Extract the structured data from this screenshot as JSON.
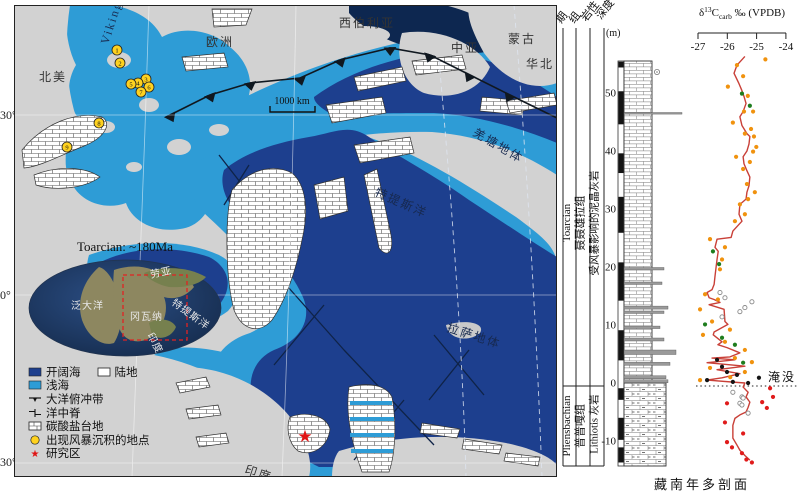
{
  "map": {
    "latitudes": [
      "30°",
      "0°",
      "30°"
    ],
    "scale_bar": "1000 km",
    "regions": [
      {
        "label": "北美",
        "x": 25,
        "y": 76
      },
      {
        "label": "欧洲",
        "x": 192,
        "y": 41
      },
      {
        "label": "西伯利亚",
        "x": 325,
        "y": 22
      },
      {
        "label": "中亚",
        "x": 437,
        "y": 47
      },
      {
        "label": "蒙古",
        "x": 494,
        "y": 38
      },
      {
        "label": "华北",
        "x": 512,
        "y": 63
      },
      {
        "label": "印度",
        "x": 230,
        "y": 468,
        "rot": 18
      },
      {
        "label": "澳大利亚",
        "x": 405,
        "y": 484
      }
    ],
    "sea_labels": [
      {
        "label": "特提斯洋",
        "x": 360,
        "y": 190,
        "rot": 24
      },
      {
        "label": "羌塘地体",
        "x": 458,
        "y": 130,
        "rot": 30
      },
      {
        "label": "拉萨地体",
        "x": 432,
        "y": 326,
        "rot": 18
      },
      {
        "label": "Viking",
        "x": 94,
        "y": 40,
        "rot": -72,
        "size": 9
      }
    ],
    "storm_sites": [
      {
        "n": "1",
        "x": 103,
        "y": 45
      },
      {
        "n": "2",
        "x": 106,
        "y": 58
      },
      {
        "n": "3",
        "x": 132,
        "y": 74
      },
      {
        "n": "4",
        "x": 124,
        "y": 78
      },
      {
        "n": "5",
        "x": 117,
        "y": 79
      },
      {
        "n": "6",
        "x": 135,
        "y": 82
      },
      {
        "n": "7",
        "x": 127,
        "y": 87
      },
      {
        "n": "8",
        "x": 85,
        "y": 118
      },
      {
        "n": "9",
        "x": 53,
        "y": 142
      }
    ],
    "study_site": {
      "x": 291,
      "y": 431,
      "glyph": "★"
    },
    "inset": {
      "title": "Toarcian: ~180Ma",
      "labels": [
        {
          "label": "泛大洋",
          "x": 57,
          "y": 304
        },
        {
          "label": "劳亚",
          "x": 137,
          "y": 273,
          "rot": -12
        },
        {
          "label": "特提斯洋",
          "x": 157,
          "y": 299,
          "rot": 36
        },
        {
          "label": "冈瓦纳",
          "x": 116,
          "y": 315
        },
        {
          "label": "印度",
          "x": 133,
          "y": 330,
          "rot": 62,
          "size": 8
        }
      ]
    },
    "legend": {
      "items": [
        {
          "type": "open-sea",
          "label": "开阔海"
        },
        {
          "type": "land",
          "label": "陆地"
        },
        {
          "type": "shallow-sea",
          "label": "浅海"
        },
        {
          "type": "subduction",
          "label": "大洋俯冲带"
        },
        {
          "type": "ridge",
          "label": "洋中脊"
        },
        {
          "type": "platform",
          "label": "碳酸盐台地"
        },
        {
          "type": "storm-site",
          "label": "出现风暴沉积的地点"
        },
        {
          "type": "study-area",
          "label": "研究区"
        }
      ]
    },
    "colors": {
      "open_sea": "#1d3f8e",
      "deep_sea": "#0d2750",
      "shallow_sea": "#2e9cd6",
      "land": "#d2d2d2"
    }
  },
  "strat": {
    "headers": {
      "stage": "期",
      "formation": "组",
      "lithology": "岩性",
      "depth": "深度",
      "depth_unit": "(m)"
    },
    "stages": [
      {
        "name": "Toarcian",
        "formation": "聂聂雄拉组",
        "description": "受风暴影响的泥晶灰岩"
      },
      {
        "name": "Pliensbachian",
        "formation": "普普嘎组",
        "description": "Lithiotis 灰岩"
      }
    ],
    "axis": {
      "delta": "δ",
      "sup": "13",
      "c": "C",
      "sub": "carb",
      "rest": " ‰ (VPDB)"
    },
    "drowning_label": "淹没",
    "section_title": "藏南年多剖面",
    "lithology": {
      "black_bar": [
        [
          55.4,
          54.4
        ],
        [
          50.3,
          44.6
        ],
        [
          39.6,
          36.2
        ],
        [
          32.1,
          25.9
        ],
        [
          20.8,
          14.2
        ],
        [
          9.1,
          3.9
        ],
        [
          -0.9,
          -2.9
        ],
        [
          -6.0,
          -9.8
        ],
        [
          -11.1,
          -13.7
        ]
      ],
      "storm_beds": [
        {
          "depth": 46.5,
          "w": 58,
          "h": 1.6
        },
        {
          "depth": 19.7,
          "w": 40,
          "h": 2.5
        },
        {
          "depth": 17.2,
          "w": 38,
          "h": 2.5
        },
        {
          "depth": 13.0,
          "w": 44,
          "h": 3
        },
        {
          "depth": 12.2,
          "w": 40,
          "h": 2.5
        },
        {
          "depth": 9.6,
          "w": 36,
          "h": 2.5
        },
        {
          "depth": 7.5,
          "w": 40,
          "h": 3
        },
        {
          "depth": 5.3,
          "w": 52,
          "h": 4.5
        },
        {
          "depth": 3.3,
          "w": 46,
          "h": 3
        },
        {
          "depth": 1.0,
          "w": 42,
          "h": 3
        },
        {
          "depth": 0.3,
          "w": 44,
          "h": 3
        }
      ]
    }
  },
  "chart_data": {
    "type": "line",
    "title": "δ13Ccarb ‰ (VPDB)",
    "xlabel": "δ13Ccarb ‰ (VPDB)",
    "ylabel": "深度 (m)",
    "xlim": [
      -27.5,
      -23.8
    ],
    "ylim": [
      -14.5,
      56
    ],
    "x_ticks": [
      -27,
      -26,
      -25,
      -24
    ],
    "depth_ticks": [
      50,
      40,
      30,
      20,
      10,
      0,
      -10
    ],
    "drowning_depth": 0,
    "curve_color": "#c94038",
    "curve": [
      [
        56.3,
        -25.4
      ],
      [
        54.8,
        -25.67
      ],
      [
        53.4,
        -25.77
      ],
      [
        51.6,
        -25.6
      ],
      [
        50.4,
        -25.5
      ],
      [
        49.4,
        -25.43
      ],
      [
        48.2,
        -25.36
      ],
      [
        46.8,
        -25.46
      ],
      [
        45.9,
        -25.57
      ],
      [
        44.4,
        -25.5
      ],
      [
        43.0,
        -25.33
      ],
      [
        42.5,
        -25.23
      ],
      [
        41.2,
        -25.26
      ],
      [
        40.0,
        -25.33
      ],
      [
        39.0,
        -25.46
      ],
      [
        37.8,
        -25.43
      ],
      [
        36.6,
        -25.33
      ],
      [
        35.5,
        -25.23
      ],
      [
        34.0,
        -25.26
      ],
      [
        32.9,
        -25.33
      ],
      [
        31.7,
        -25.36
      ],
      [
        30.8,
        -25.57
      ],
      [
        29.1,
        -25.6
      ],
      [
        27.9,
        -25.5
      ],
      [
        26.2,
        -25.81
      ],
      [
        25.1,
        -25.87
      ],
      [
        24.8,
        -26.35
      ],
      [
        23.4,
        -26.42
      ],
      [
        22.7,
        -26.31
      ],
      [
        21.3,
        -26.35
      ],
      [
        20.1,
        -26.38
      ],
      [
        18.4,
        -26.42
      ],
      [
        17.0,
        -26.45
      ],
      [
        16.1,
        -26.52
      ],
      [
        15.6,
        -26.69
      ],
      [
        14.7,
        -26.62
      ],
      [
        14.4,
        -26.45
      ],
      [
        13.9,
        -26.25
      ],
      [
        13.5,
        -26.62
      ],
      [
        12.7,
        -26.11
      ],
      [
        10.6,
        -26.08
      ],
      [
        10.1,
        -25.98
      ],
      [
        8.8,
        -26.45
      ],
      [
        8.3,
        -26.48
      ],
      [
        7.1,
        -26.18
      ],
      [
        6.6,
        -26.32
      ],
      [
        6.1,
        -26.01
      ],
      [
        5.4,
        -25.67
      ],
      [
        5.2,
        -25.57
      ],
      [
        4.5,
        -25.91
      ],
      [
        4.3,
        -26.52
      ],
      [
        4.0,
        -25.74
      ],
      [
        3.5,
        -26.69
      ],
      [
        2.9,
        -25.4
      ],
      [
        2.3,
        -26.35
      ],
      [
        1.6,
        -25.57
      ],
      [
        0.9,
        -26.18
      ],
      [
        0.5,
        -26.69
      ],
      [
        0.0,
        -25.4
      ],
      [
        -0.7,
        -25.46
      ],
      [
        -1.6,
        -25.29
      ],
      [
        -2.4,
        -25.36
      ],
      [
        -3.3,
        -25.23
      ],
      [
        -4.2,
        -25.29
      ],
      [
        -5.0,
        -25.36
      ],
      [
        -5.5,
        -25.57
      ],
      [
        -6.1,
        -25.74
      ],
      [
        -7.3,
        -25.81
      ],
      [
        -8.5,
        -25.81
      ],
      [
        -9.5,
        -25.81
      ],
      [
        -10.7,
        -25.67
      ],
      [
        -11.6,
        -25.57
      ],
      [
        -12.5,
        -25.4
      ],
      [
        -13.3,
        -25.23
      ]
    ],
    "series": [
      {
        "name": "orange-dots",
        "color": "#f0920e",
        "points": [
          [
            55.8,
            -24.7
          ],
          [
            54.8,
            -25.67
          ],
          [
            52.9,
            -25.46
          ],
          [
            51.1,
            -25.98
          ],
          [
            49.5,
            -25.3
          ],
          [
            46.8,
            -25.43
          ],
          [
            46.8,
            -25.12
          ],
          [
            44.9,
            -25.81
          ],
          [
            43.8,
            -25.19
          ],
          [
            43.0,
            -25.4
          ],
          [
            42.5,
            -25.09
          ],
          [
            40.7,
            -25.01
          ],
          [
            39.9,
            -25.12
          ],
          [
            39.0,
            -25.7
          ],
          [
            38.1,
            -25.23
          ],
          [
            36.9,
            -25.46
          ],
          [
            34.3,
            -25.33
          ],
          [
            32.9,
            -25.06
          ],
          [
            31.7,
            -25.29
          ],
          [
            30.8,
            -25.57
          ],
          [
            29.1,
            -25.4
          ],
          [
            27.9,
            -25.74
          ],
          [
            24.8,
            -26.59
          ],
          [
            23.4,
            -26.08
          ],
          [
            21.3,
            -26.18
          ],
          [
            19.6,
            -26.25
          ],
          [
            15.3,
            -26.76
          ],
          [
            14.4,
            -26.32
          ],
          [
            12.7,
            -26.93
          ],
          [
            10.6,
            -26.52
          ],
          [
            9.2,
            -25.91
          ],
          [
            8.3,
            -26.83
          ],
          [
            7.1,
            -26.08
          ],
          [
            5.7,
            -25.4
          ],
          [
            4.3,
            -25.74
          ],
          [
            3.6,
            -25.16
          ],
          [
            2.6,
            -26.59
          ],
          [
            1.9,
            -25.4
          ],
          [
            1.0,
            -25.9
          ],
          [
            0.5,
            -26.93
          ]
        ]
      },
      {
        "name": "green-dots",
        "color": "#1e7d1e",
        "points": [
          [
            49.9,
            -25.5
          ],
          [
            47.8,
            -25.23
          ],
          [
            22.7,
            -26.49
          ],
          [
            20.5,
            -26.28
          ],
          [
            10.1,
            -26.76
          ],
          [
            7.8,
            -26.18
          ],
          [
            6.6,
            -25.74
          ],
          [
            3.5,
            -25.46
          ]
        ]
      },
      {
        "name": "black-dots",
        "color": "#141414",
        "points": [
          [
            4.0,
            -26.35
          ],
          [
            2.8,
            -26.18
          ],
          [
            1.9,
            -26.01
          ],
          [
            1.4,
            -25.67
          ],
          [
            0.5,
            -26.69
          ],
          [
            0.2,
            -25.81
          ],
          [
            0.9,
            -24.92
          ],
          [
            0.0,
            -25.29
          ]
        ]
      },
      {
        "name": "red-dots",
        "color": "#e01b1b",
        "points": [
          [
            -0.9,
            -24.54
          ],
          [
            -2.4,
            -24.44
          ],
          [
            -3.3,
            -24.81
          ],
          [
            -3.5,
            -26.01
          ],
          [
            -4.3,
            -24.65
          ],
          [
            -6.8,
            -26.08
          ],
          [
            -8.7,
            -25.46
          ],
          [
            -10.2,
            -26.01
          ],
          [
            -11.1,
            -25.84
          ],
          [
            -12.1,
            -25.5
          ],
          [
            -13.7,
            -25.16
          ],
          [
            -13.2,
            -25.35
          ]
        ]
      },
      {
        "name": "open-circles",
        "color": "open",
        "points": [
          [
            15.6,
            -26.25
          ],
          [
            14.7,
            -26.08
          ],
          [
            14.0,
            -25.16
          ],
          [
            13.0,
            -25.4
          ],
          [
            12.3,
            -25.57
          ],
          [
            11.4,
            -26.18
          ],
          [
            -1.6,
            -25.81
          ],
          [
            -2.4,
            -25.5
          ],
          [
            -2.6,
            -25.46
          ],
          [
            -3.5,
            -25.57
          ],
          [
            -3.8,
            -25.5
          ],
          [
            -5.2,
            -25.29
          ]
        ]
      }
    ]
  }
}
